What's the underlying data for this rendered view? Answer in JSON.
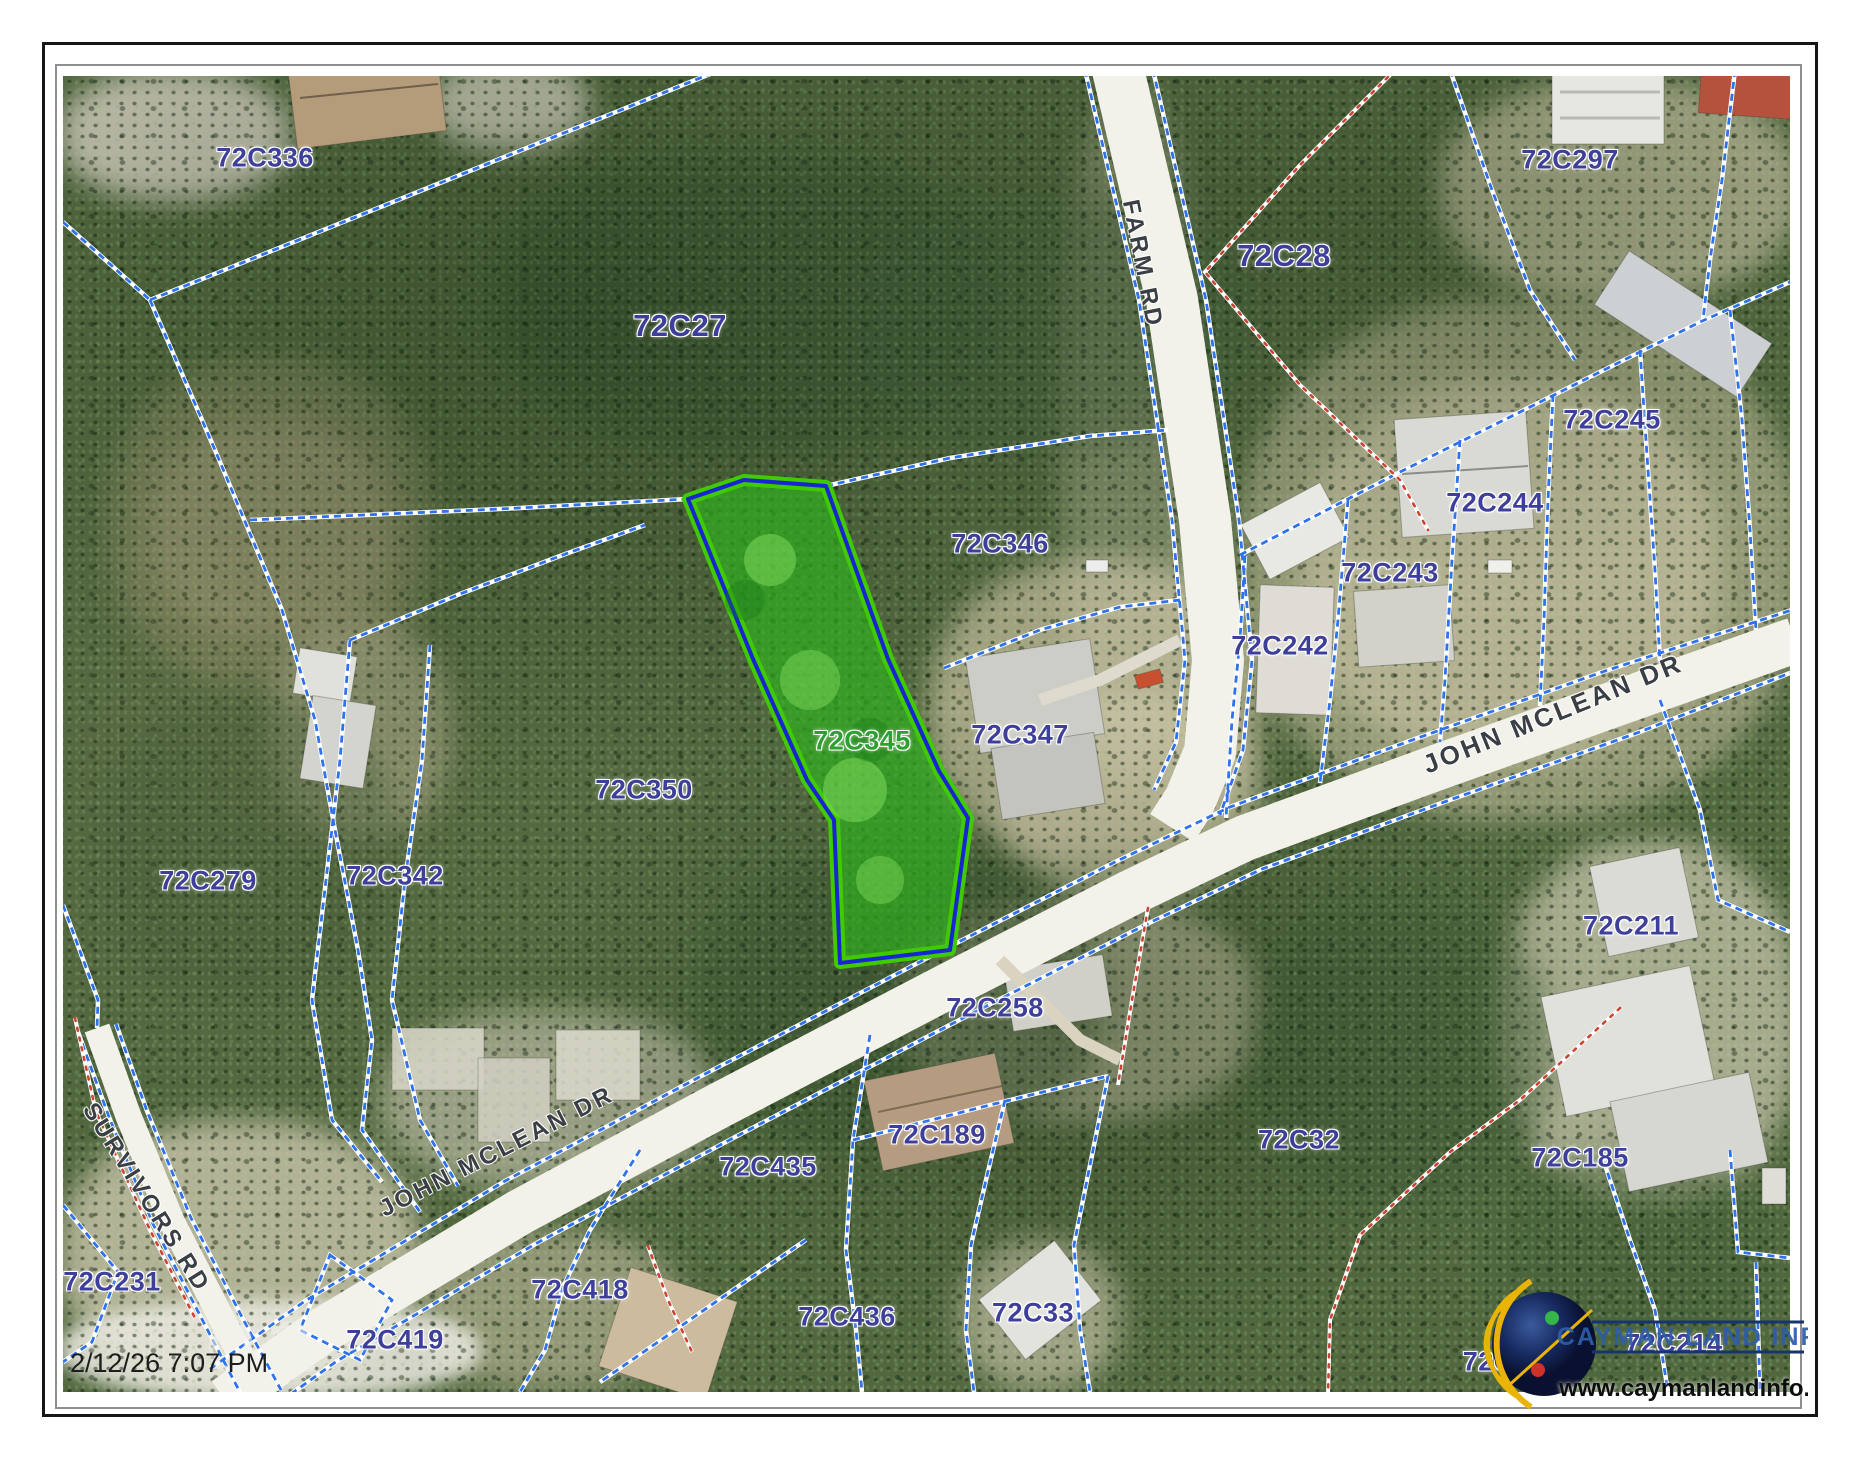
{
  "map": {
    "parcel_labels": [
      {
        "text": "72C336"
      },
      {
        "text": "72C27"
      },
      {
        "text": "72C28"
      },
      {
        "text": "72C297"
      },
      {
        "text": "72C245"
      },
      {
        "text": "72C244"
      },
      {
        "text": "72C243"
      },
      {
        "text": "72C242"
      },
      {
        "text": "72C346"
      },
      {
        "text": "72C347"
      },
      {
        "text": "72C350"
      },
      {
        "text": "72C342"
      },
      {
        "text": "72C279"
      },
      {
        "text": "72C231"
      },
      {
        "text": "72C258"
      },
      {
        "text": "72C189"
      },
      {
        "text": "72C435"
      },
      {
        "text": "72C419"
      },
      {
        "text": "72C418"
      },
      {
        "text": "72C436"
      },
      {
        "text": "72C33"
      },
      {
        "text": "72C32"
      },
      {
        "text": "72C185"
      },
      {
        "text": "72C211"
      },
      {
        "text": "72C214"
      },
      {
        "text": "72C3"
      },
      {
        "text": "72C345"
      }
    ],
    "road_labels": [
      {
        "name": "FARM RD"
      },
      {
        "name": "JOHN MCLEAN DR"
      },
      {
        "name": "JOHN MCLEAN DR"
      },
      {
        "name": "SURVIVORS RD"
      }
    ],
    "highlighted_parcel": "72C345",
    "colors": {
      "parcel_line": "#2f72ec",
      "survey_line": "#cc4333",
      "highlight_fill": "#2eb41e",
      "highlight_outline": "#3fcb00",
      "highlight_inner_line": "#1726cf",
      "parcel_label": "#3d3f9a",
      "highlight_label": "#2f9e33",
      "road_label": "#3a3f45"
    }
  },
  "status": {
    "timestamp": "2/12/26 7:07 PM"
  },
  "watermark": {
    "text": "oa"
  },
  "logo": {
    "title": "CAYMAN LAND INFO",
    "url": "www.caymanlandinfo.ky"
  }
}
